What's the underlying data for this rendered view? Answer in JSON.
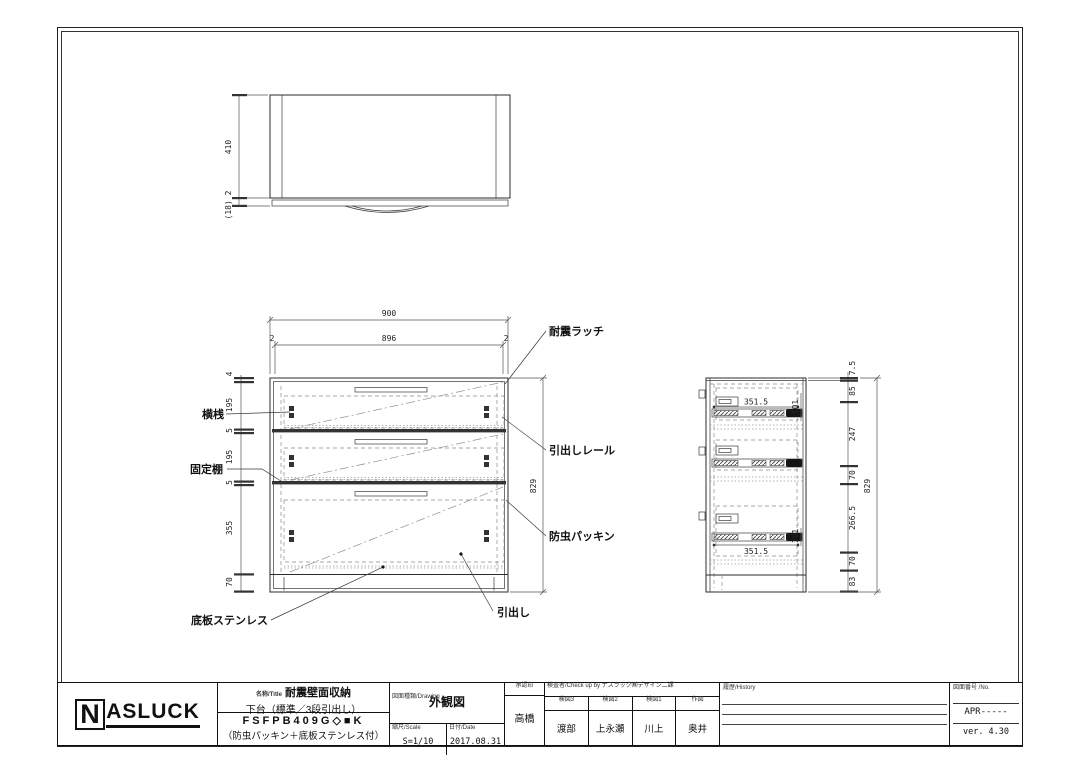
{
  "top_view": {
    "height": "410",
    "edge_note": "(18) 2"
  },
  "front_view": {
    "dim_overall_w": "900",
    "dim_inner_w": "896",
    "dim_gap_left": "2",
    "dim_gap_right": "2",
    "dims_left": [
      "4",
      "195",
      "5",
      "195",
      "5",
      "355",
      "70"
    ],
    "dim_height": "829",
    "labels": {
      "yokozan": "横桟",
      "kotei_dana": "固定棚",
      "taishin_latch": "耐震ラッチ",
      "hikidashi_rail": "引出しレール",
      "bochu_packing": "防虫パッキン",
      "hikidashi": "引出し",
      "teiban_stainless": "底板ステンレス"
    }
  },
  "side_view": {
    "dims_right": [
      "7.5",
      "85",
      "247",
      "70",
      "266.5",
      "70",
      "83"
    ],
    "dim_height": "829",
    "rail_len_top": "351.5",
    "rail_len_bottom": "351.5",
    "rail_h_top": "101",
    "rail_h_bottom": "101"
  },
  "title_block": {
    "logo_n": "N",
    "logo_rest": "ASLUCK",
    "title_label": "名称/Title",
    "title_line1": "耐震壁面収納",
    "title_line2": "下台（標準／3段引出し）",
    "model": "FSFPB409G◇■K",
    "note": "（防虫パッキン＋底板ステンレス付）",
    "drawing_label": "図面種類/Drawing",
    "drawing_type": "外観図",
    "scale_label": "縮尺/Scale",
    "scale": "S=1/10",
    "date_label": "日付/Date",
    "date": "2017.08.31",
    "approval_label": "承認印",
    "approval_name": "高橋",
    "check_label": "検査者/Check up by ナスラック㈱デザイン二課",
    "check_cols": [
      {
        "label": "検図3",
        "name": "渡部"
      },
      {
        "label": "検図2",
        "name": "上永瀬"
      },
      {
        "label": "検図1",
        "name": "川上"
      },
      {
        "label": "作図",
        "name": "奥井"
      }
    ],
    "history_label": "履歴/History",
    "number_label": "図面番号 /No.",
    "number": "APR-----",
    "version": "ver. 4.30"
  }
}
